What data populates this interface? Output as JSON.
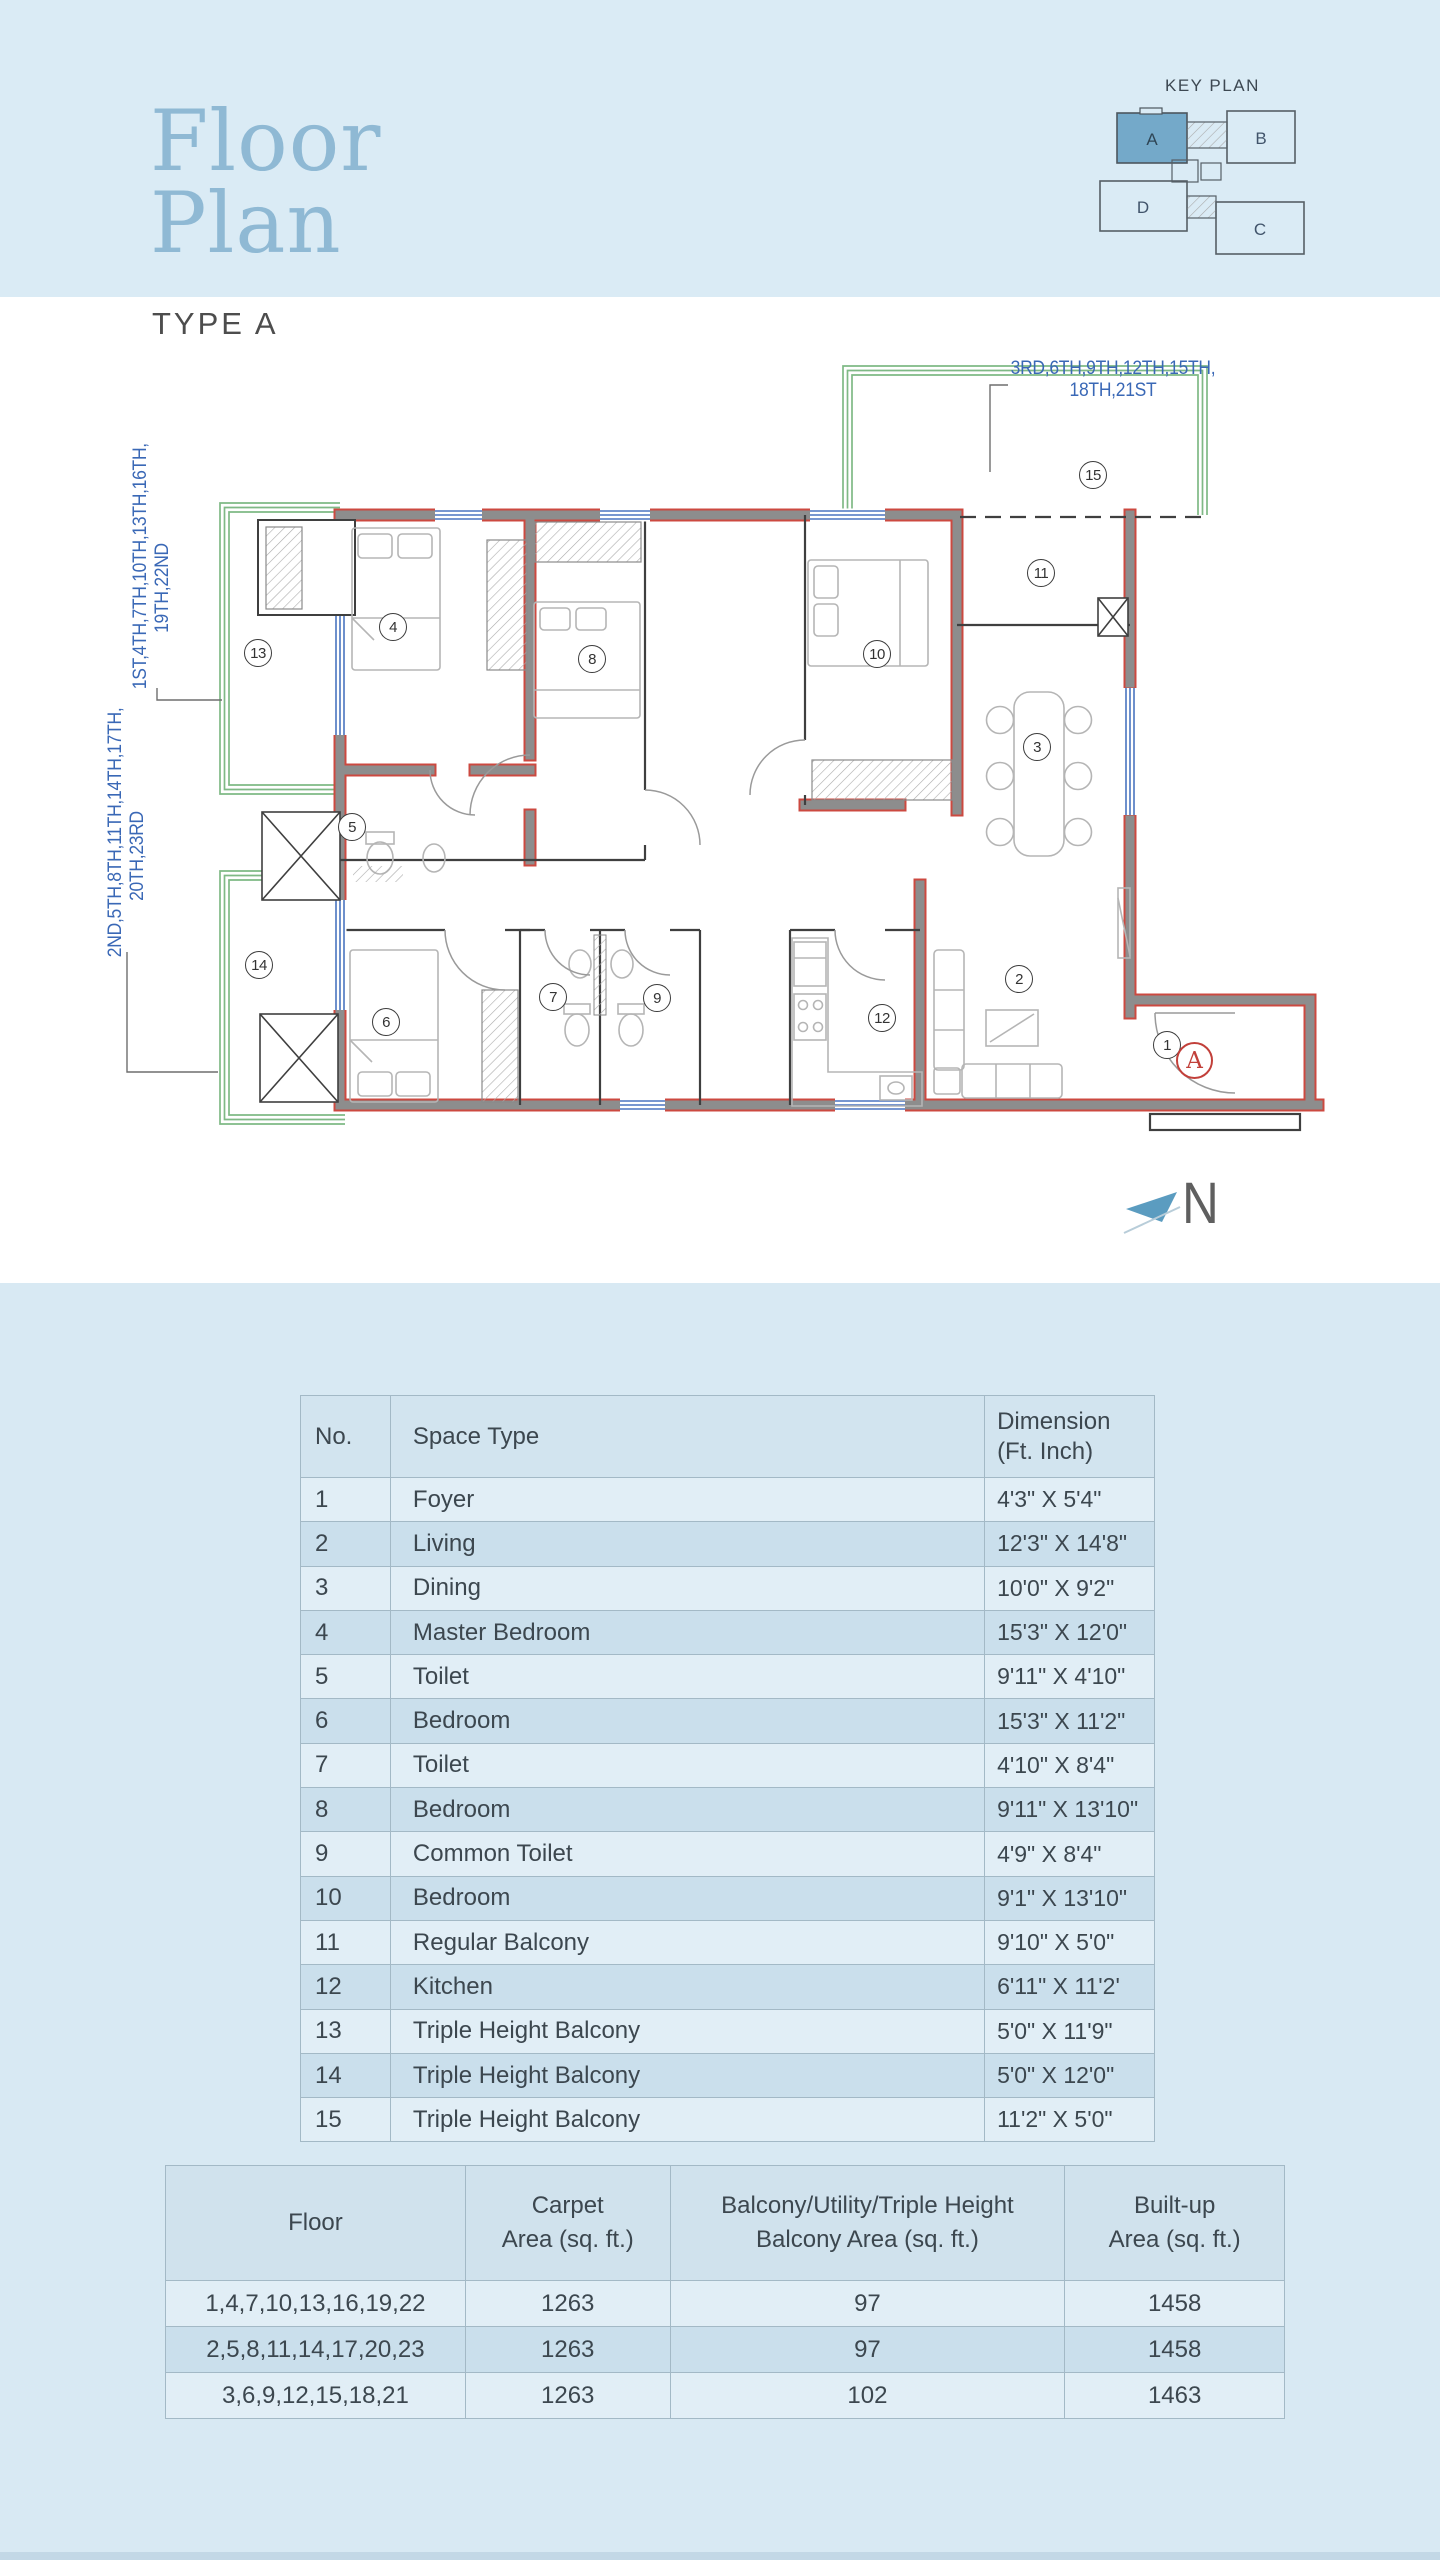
{
  "header": {
    "title_lines": [
      "Floor",
      "Plan"
    ],
    "type_label": "TYPE A",
    "key_plan": {
      "title": "KEY PLAN",
      "block_a": "A",
      "block_b": "B",
      "block_c": "C",
      "block_d": "D"
    }
  },
  "plan": {
    "label_top": [
      "3RD,6TH,9TH,12TH,15TH,",
      "18TH,21ST"
    ],
    "label_left_upper": [
      "1ST,4TH,7TH,10TH,13TH,16TH,",
      "19TH,22ND"
    ],
    "label_left_lower": [
      "2ND,5TH,8TH,11TH,14TH,17TH,",
      "20TH,23RD"
    ],
    "unit_circle_label": "A",
    "north_label": "N",
    "markers": [
      {
        "n": "1",
        "x": 1167,
        "y": 1045
      },
      {
        "n": "2",
        "x": 1019,
        "y": 979
      },
      {
        "n": "3",
        "x": 1037,
        "y": 747
      },
      {
        "n": "4",
        "x": 393,
        "y": 627
      },
      {
        "n": "5",
        "x": 352,
        "y": 827
      },
      {
        "n": "6",
        "x": 386,
        "y": 1022
      },
      {
        "n": "7",
        "x": 553,
        "y": 997
      },
      {
        "n": "8",
        "x": 592,
        "y": 659
      },
      {
        "n": "9",
        "x": 657,
        "y": 998
      },
      {
        "n": "10",
        "x": 877,
        "y": 654
      },
      {
        "n": "11",
        "x": 1041,
        "y": 573
      },
      {
        "n": "12",
        "x": 882,
        "y": 1018
      },
      {
        "n": "13",
        "x": 258,
        "y": 653
      },
      {
        "n": "14",
        "x": 259,
        "y": 965
      },
      {
        "n": "15",
        "x": 1093,
        "y": 475
      }
    ]
  },
  "space_table": {
    "headers": [
      [
        "No."
      ],
      [
        "Space Type"
      ],
      [
        "Dimension",
        "(Ft. Inch)"
      ]
    ],
    "rows": [
      [
        "1",
        "Foyer",
        "4'3\" X 5'4\""
      ],
      [
        "2",
        "Living",
        "12'3\" X 14'8\""
      ],
      [
        "3",
        "Dining",
        "10'0\" X 9'2\""
      ],
      [
        "4",
        "Master Bedroom",
        "15'3\" X 12'0\""
      ],
      [
        "5",
        "Toilet",
        "9'11\" X 4'10\""
      ],
      [
        "6",
        "Bedroom",
        "15'3\" X 11'2\""
      ],
      [
        "7",
        "Toilet",
        "4'10\" X 8'4\""
      ],
      [
        "8",
        "Bedroom",
        "9'11\" X 13'10\""
      ],
      [
        "9",
        "Common Toilet",
        "4'9\" X 8'4\""
      ],
      [
        "10",
        "Bedroom",
        "9'1\" X 13'10\""
      ],
      [
        "11",
        "Regular Balcony",
        "9'10\" X 5'0\""
      ],
      [
        "12",
        "Kitchen",
        "6'11\" X 11'2'"
      ],
      [
        "13",
        "Triple Height Balcony",
        "5'0\" X 11'9\""
      ],
      [
        "14",
        "Triple Height Balcony",
        "5'0\" X 12'0\""
      ],
      [
        "15",
        "Triple Height Balcony",
        "11'2\" X 5'0\""
      ]
    ]
  },
  "area_table": {
    "headers": [
      [
        "Floor"
      ],
      [
        "Carpet",
        "Area (sq. ft.)"
      ],
      [
        "Balcony/Utility/Triple Height",
        "Balcony Area (sq. ft.)"
      ],
      [
        "Built-up",
        "Area (sq. ft.)"
      ]
    ],
    "rows": [
      [
        "1,4,7,10,13,16,19,22",
        "1263",
        "97",
        "1458"
      ],
      [
        "2,5,8,11,14,17,20,23",
        "1263",
        "97",
        "1458"
      ],
      [
        "3,6,9,12,15,18,21",
        "1263",
        "102",
        "1463"
      ]
    ]
  },
  "colors": {
    "band": "#daebf5",
    "title_blue": "#8fb9d4",
    "label_blue": "#3a68b6",
    "wall_gray": "#8d8d8d",
    "wall_red": "#cc4940",
    "balcony_green": "#7fb985",
    "window_blue": "#4a74c0",
    "keyplan_fill": "#74a9c9",
    "north_fill": "#5b9cc0"
  }
}
